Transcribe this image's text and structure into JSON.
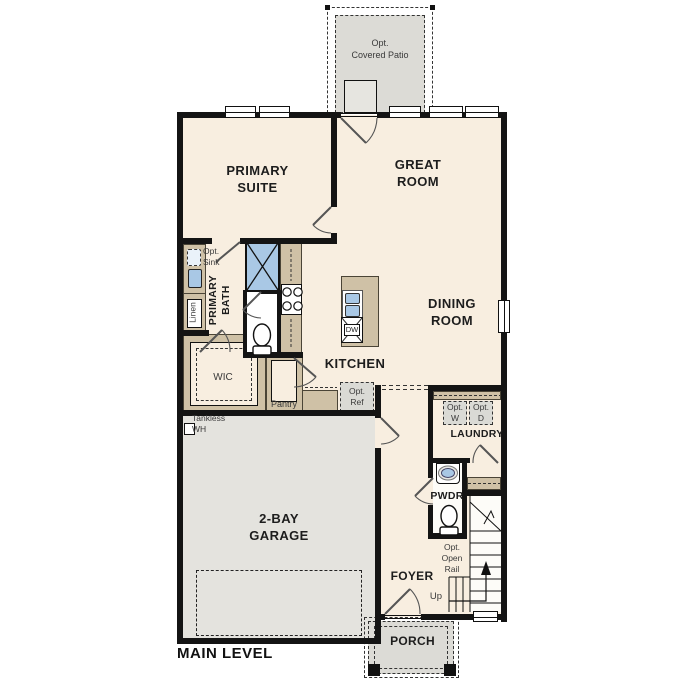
{
  "title": "MAIN LEVEL",
  "rooms": {
    "primary_suite": "PRIMARY\nSUITE",
    "great_room": "GREAT\nROOM",
    "dining_room": "DINING\nROOM",
    "kitchen": "KITCHEN",
    "garage": "2-BAY\nGARAGE",
    "foyer": "FOYER",
    "porch": "PORCH",
    "laundry": "LAUNDRY",
    "pwdr": "PWDR",
    "wic": "WIC",
    "primary_bath": "PRIMARY\nBATH",
    "pantry": "Pantry",
    "linen": "Linen"
  },
  "annotations": {
    "opt_covered_patio": "Opt.\nCovered Patio",
    "opt_sink": "Opt.\nSink",
    "opt_ref": "Opt.\nRef",
    "opt_w": "Opt.\nW",
    "opt_d": "Opt.\nD",
    "opt_open_rail": "Opt.\nOpen\nRail",
    "tankless_wh": "Tankless\nWH",
    "up": "Up",
    "dw": "DW"
  },
  "colors": {
    "floor": "#f8eee0",
    "wall": "#141414",
    "cabinet": "#cfc1a6",
    "concrete": "#dcdbd6",
    "garage_floor": "#e4e3de",
    "fixture_blue": "#a9c8e5",
    "optional_gray": "#dadad5"
  }
}
